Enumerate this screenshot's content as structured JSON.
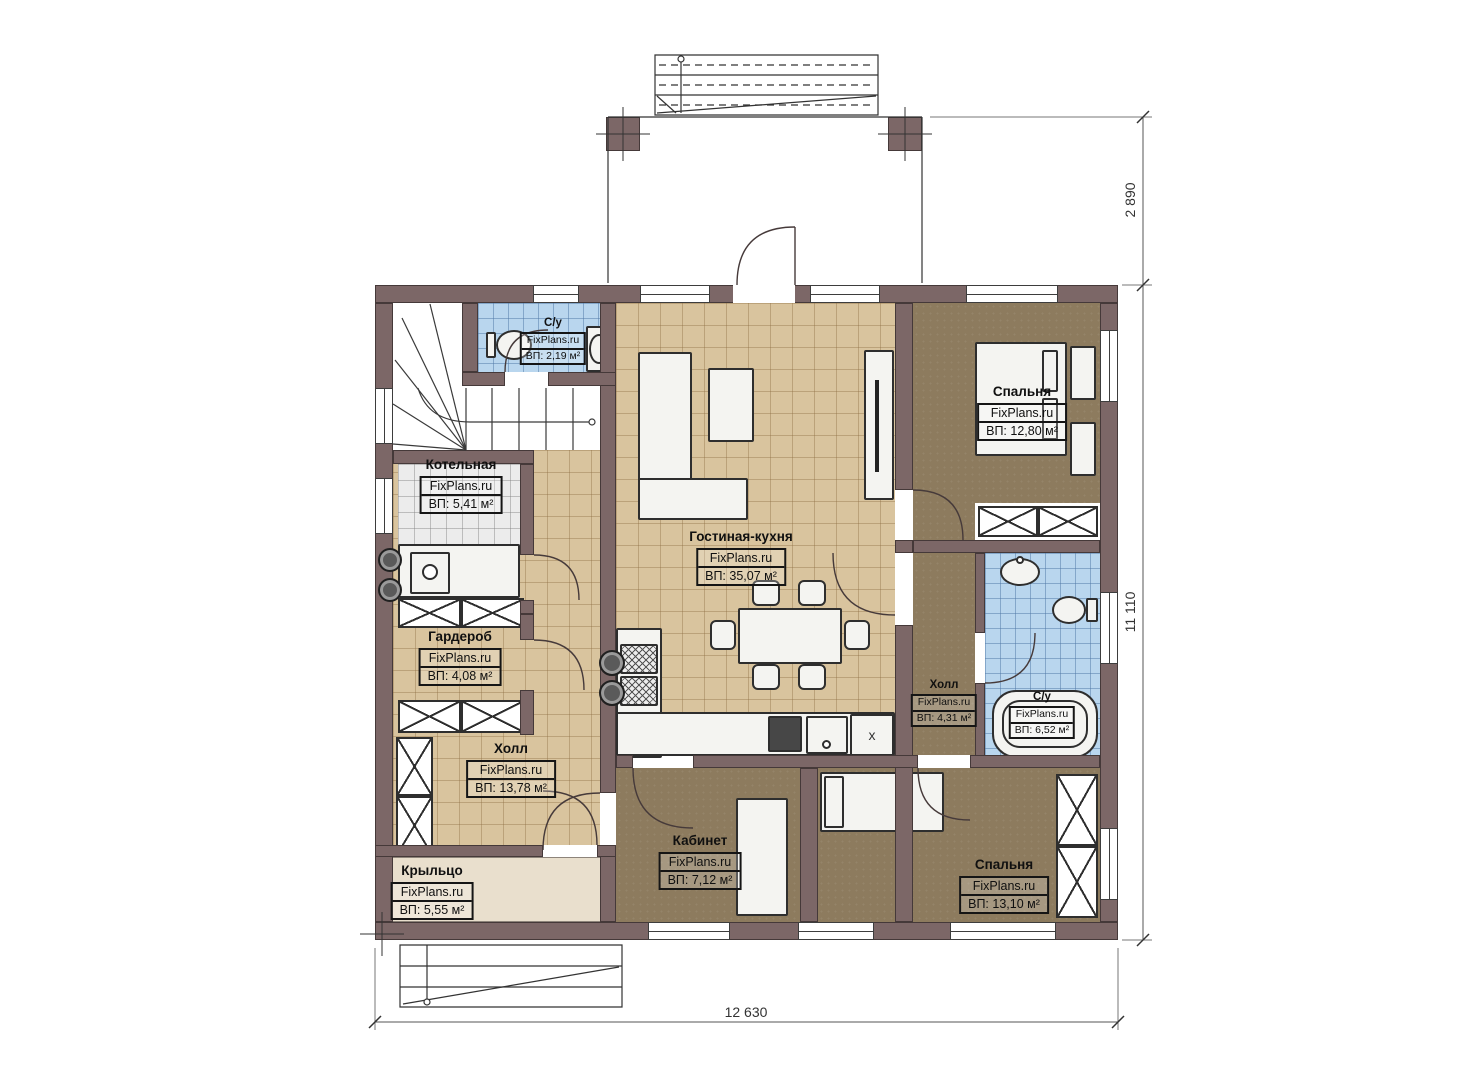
{
  "watermark": "FixPlans.ru",
  "rooms": {
    "wc1": {
      "name": "С/у",
      "area": "ВП: 2,19 м²"
    },
    "boiler": {
      "name": "Котельная",
      "area": "ВП: 5,41 м²"
    },
    "wardrobe": {
      "name": "Гардероб",
      "area": "ВП: 4,08 м²"
    },
    "hall_main": {
      "name": "Холл",
      "area": "ВП: 13,78 м²"
    },
    "porch": {
      "name": "Крыльцо",
      "area": "ВП: 5,55 м²"
    },
    "living_kitchen": {
      "name": "Гостиная-кухня",
      "area": "ВП: 35,07 м²"
    },
    "bedroom1": {
      "name": "Спальня",
      "area": "ВП: 12,80 м²"
    },
    "hall_small": {
      "name": "Холл",
      "area": "ВП: 4,31 м²"
    },
    "wc2": {
      "name": "С/у",
      "area": "ВП: 6,52 м²"
    },
    "office": {
      "name": "Кабинет",
      "area": "ВП: 7,12 м²"
    },
    "bedroom2": {
      "name": "Спальня",
      "area": "ВП: 13,10 м²"
    }
  },
  "dimensions": {
    "terrace_depth": "2 890",
    "house_depth": "11 110",
    "house_width": "12 630"
  },
  "kitchen_cabinet_mark": "x",
  "palette": {
    "wall": "#7c6767",
    "tile_tan": "#d9c49e",
    "tile_blue": "#b9d6ee",
    "tile_gray": "#ececec",
    "floor_brown": "#8d7b5e",
    "porch": "#e9dfcd"
  }
}
